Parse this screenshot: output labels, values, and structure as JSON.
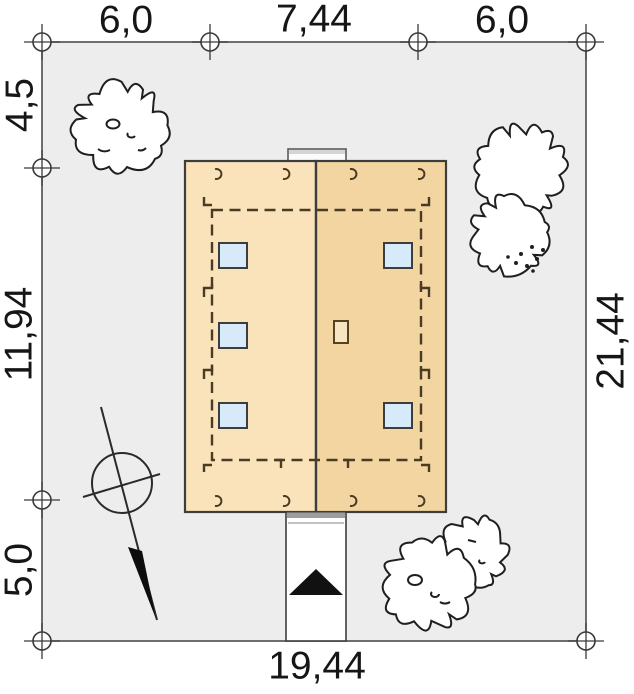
{
  "site_plan": {
    "dimensions": {
      "top": [
        "6,0",
        "7,44",
        "6,0"
      ],
      "left": [
        "4,5",
        "11,94",
        "5,0"
      ],
      "right": [
        "21,44"
      ],
      "bottom": [
        "19,44"
      ]
    },
    "features": {
      "trees": 5,
      "skylights": 5,
      "north_arrow": "north-arrow",
      "entrance_marker": "entrance-arrow",
      "driveway": "driveway",
      "house": "roof-plan"
    },
    "colors": {
      "plot_fill": "#ededed",
      "plot_stroke": "#4d4d4d",
      "roof_left": "#fae3bb",
      "roof_right": "#f2d5a0",
      "roof_stroke": "#3d3d3d",
      "dashed_outline": "#4a3c22",
      "skylight_fill": "#d6eafa",
      "chimney_fill": "#f7e4c0",
      "driveway_fill": "#ffffff",
      "arrow_black": "#111111",
      "tree_stroke": "#1f1f1f",
      "text": "#161616"
    }
  }
}
